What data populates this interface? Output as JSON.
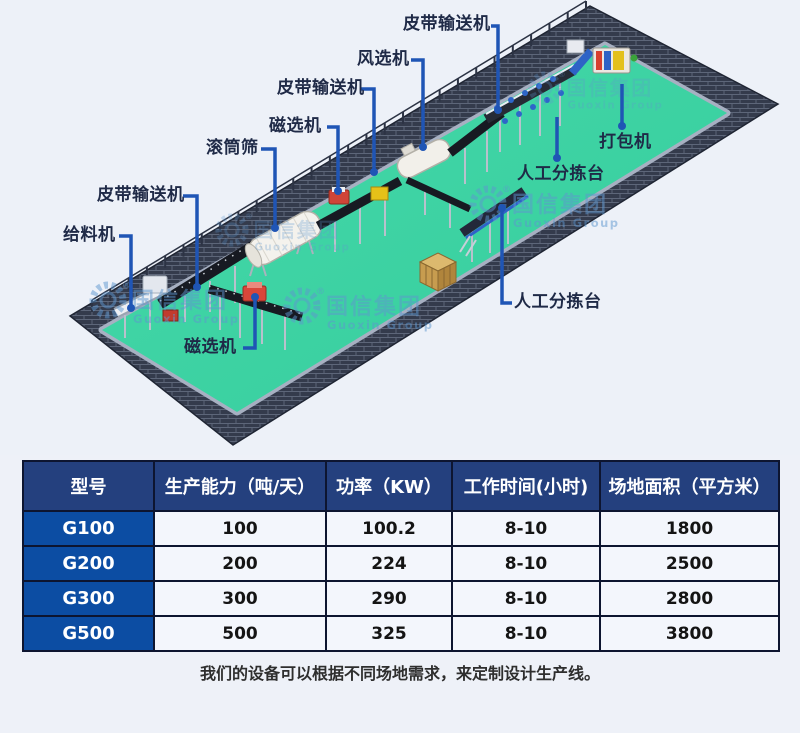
{
  "diagram": {
    "labels": [
      {
        "id": "belt-conveyor-top",
        "text": "皮带输送机"
      },
      {
        "id": "air-separator",
        "text": "风选机"
      },
      {
        "id": "belt-conveyor-mid",
        "text": "皮带输送机"
      },
      {
        "id": "magnetic-separator-upper",
        "text": "磁选机"
      },
      {
        "id": "drum-screen",
        "text": "滚筒筛"
      },
      {
        "id": "belt-conveyor-left",
        "text": "皮带输送机"
      },
      {
        "id": "feeder",
        "text": "给料机"
      },
      {
        "id": "magnetic-separator-lower",
        "text": "磁选机"
      },
      {
        "id": "sorting-station-upper",
        "text": "人工分拣台"
      },
      {
        "id": "baler",
        "text": "打包机"
      },
      {
        "id": "sorting-station-lower",
        "text": "人工分拣台"
      }
    ],
    "watermark": {
      "cn": "国信集团",
      "en": "Guoxin Group",
      "registered": "®"
    },
    "colors": {
      "floor": "#3ed2a3",
      "wall": "#343b4c",
      "connector": "#1f55b5",
      "label_text": "#1f2a47",
      "watermark": "#5e97cf"
    }
  },
  "table": {
    "headers": [
      "型号",
      "生产能力（吨/天）",
      "功率（KW）",
      "工作时间(小时)",
      "场地面积（平方米）"
    ],
    "rows": [
      {
        "model": "G100",
        "values": [
          "100",
          "100.2",
          "8-10",
          "1800"
        ]
      },
      {
        "model": "G200",
        "values": [
          "200",
          "224",
          "8-10",
          "2500"
        ]
      },
      {
        "model": "G300",
        "values": [
          "300",
          "290",
          "8-10",
          "2800"
        ]
      },
      {
        "model": "G500",
        "values": [
          "500",
          "325",
          "8-10",
          "3800"
        ]
      }
    ],
    "colors": {
      "header_bg": "#24407e",
      "model_bg": "#0c4da3",
      "border": "#0d1530"
    }
  },
  "caption": "我们的设备可以根据不同场地需求，来定制设计生产线。"
}
